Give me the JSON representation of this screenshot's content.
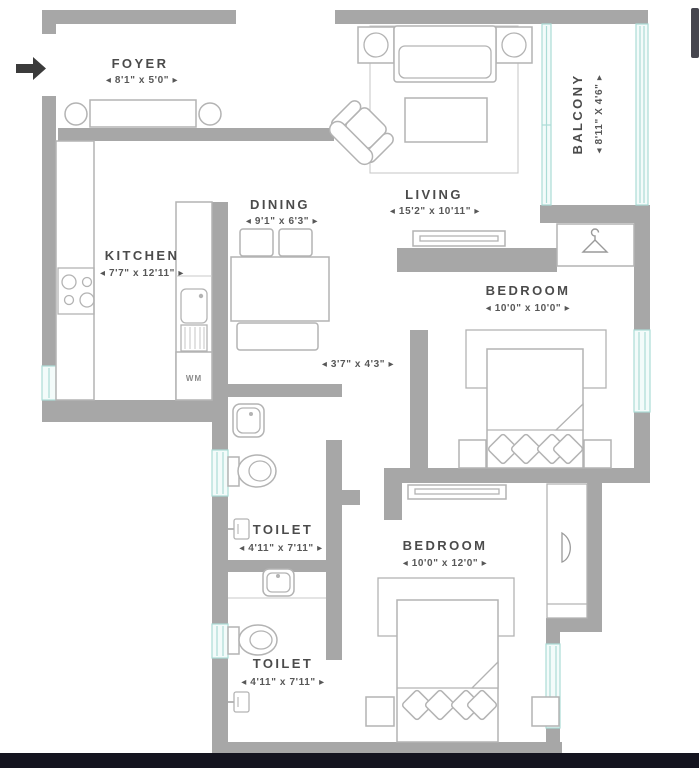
{
  "colors": {
    "wall": "#a7a7a7",
    "furniture_outline": "#b3b3b3",
    "label_text": "#4b4b4b",
    "window_glass": "#abdcd6",
    "entry_arrow": "#3b3b3b",
    "bottom_bar": "#14141f",
    "scrollbar": "#45454e"
  },
  "plan": {
    "foyer": {
      "name": "FOYER",
      "dims": "◂ 8'1\" x 5'0\" ▸"
    },
    "kitchen": {
      "name": "KITCHEN",
      "dims": "◂ 7'7\" x 12'11\" ▸"
    },
    "dining": {
      "name": "DINING",
      "dims": "◂ 9'1\" x 6'3\" ▸"
    },
    "living": {
      "name": "LIVING",
      "dims": "◂ 15'2\" x 10'11\" ▸"
    },
    "balcony": {
      "name": "BALCONY",
      "dims": "◂ 8'11\" X 4'6\" ▸"
    },
    "bedroom1": {
      "name": "BEDROOM",
      "dims": "◂ 10'0\" x 10'0\" ▸"
    },
    "bedroom2": {
      "name": "BEDROOM",
      "dims": "◂ 10'0\" x 12'0\" ▸"
    },
    "toilet1": {
      "name": "TOILET",
      "dims": "◂ 4'11\" x 7'11\" ▸"
    },
    "toilet2": {
      "name": "TOILET",
      "dims": "◂ 4'11\" x 7'11\" ▸"
    },
    "passage": {
      "dims": "◂ 3'7\" x 4'3\" ▸"
    },
    "washing_machine": {
      "label": "WM"
    }
  }
}
